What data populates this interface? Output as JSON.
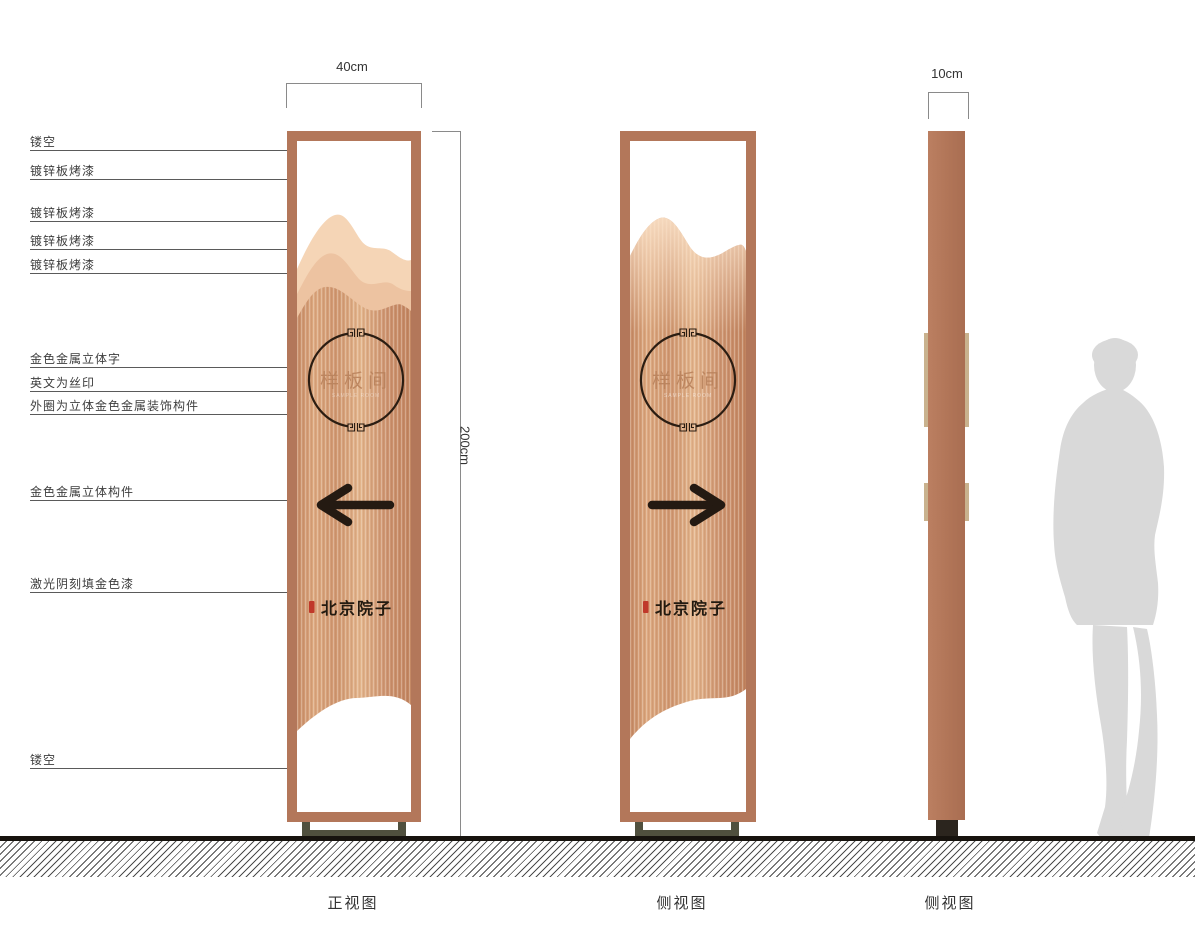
{
  "drawing": {
    "dimensions": {
      "width": "40cm",
      "height": "200cm",
      "depth": "10cm"
    },
    "annotations": [
      {
        "label": "镂空"
      },
      {
        "label": "镀锌板烤漆"
      },
      {
        "label": "镀锌板烤漆"
      },
      {
        "label": "镀锌板烤漆"
      },
      {
        "label": "镀锌板烤漆"
      },
      {
        "label": "金色金属立体字"
      },
      {
        "label": "英文为丝印"
      },
      {
        "label": "外圈为立体金色金属装饰构件"
      },
      {
        "label": "金色金属立体构件"
      },
      {
        "label": "激光阴刻填金色漆"
      },
      {
        "label": "镂空"
      }
    ],
    "views": [
      {
        "label": "正视图"
      },
      {
        "label": "侧视图"
      },
      {
        "label": "侧视图"
      }
    ],
    "sign": {
      "emblem_text": "样板间",
      "emblem_subtext": "SAMPLE ROOM",
      "brand_text": "北京院子"
    },
    "colors": {
      "frame": "#b3775a",
      "copper": "#d3996f",
      "panel_light": "#f3d0b0",
      "accent_dark": "#2a1c11",
      "seal_red": "#c0392a",
      "base": "#50503e",
      "tan_strip": "#c9b28e",
      "silhouette": "#d9d9d9"
    }
  }
}
